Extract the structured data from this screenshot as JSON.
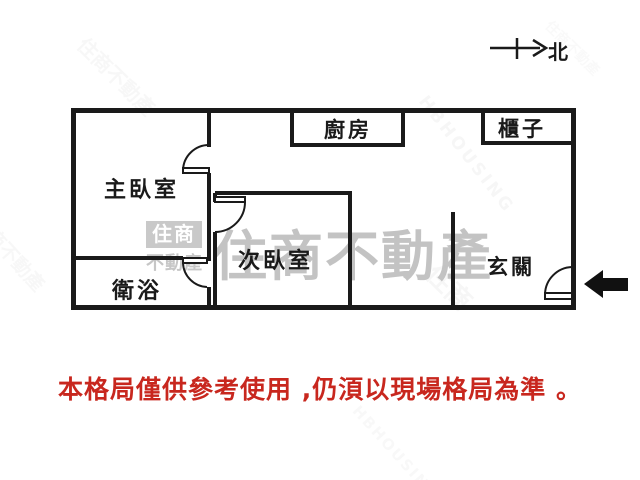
{
  "compass": {
    "label": "北"
  },
  "rooms": {
    "master_bedroom": {
      "label": "主臥室"
    },
    "bathroom": {
      "label": "衛浴"
    },
    "second_bedroom": {
      "label": "次臥室"
    },
    "kitchen": {
      "label": "廚房"
    },
    "cabinet": {
      "label": "櫃子"
    },
    "entry": {
      "label": "玄關"
    }
  },
  "disclaimer": {
    "text": "本格局僅供參考使用 ,仍湏以現場格局為準 。",
    "color": "#c8271e"
  },
  "watermarks": {
    "logo_top": "住商",
    "logo_bottom": "不動產",
    "large_text": "住商不動產",
    "tile_text": "住商不動產",
    "tile_text_en": "HBHOUSING"
  },
  "colors": {
    "wall": "#1a1a1a",
    "label": "#1a1a1a",
    "disclaimer_red": "#c8271e",
    "watermark_gray": "#b9b9b9",
    "entry_arrow": "#111111"
  }
}
